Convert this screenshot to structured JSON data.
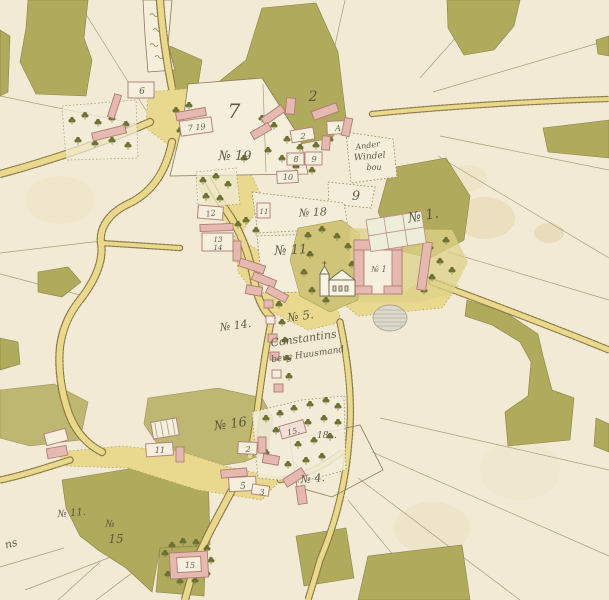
{
  "map": {
    "palette": {
      "parchment": "#f2ead4",
      "woodland_green": "#b0aa5c",
      "road_yellow": "#e9d98c",
      "road_edge_brown": "#8c7a48",
      "building_pink": "#e5b9b0",
      "building_outline": "#b5837d",
      "ink_text": "#55503e",
      "tree_green": "#6c7031",
      "pond_grey": "#dcd9ca"
    },
    "icons": {
      "tree": "broadleaf-tree-glyph",
      "church": "church-elevation-drawing",
      "pond": "hatched-oval-pond",
      "marsh": "squiggle-marsh-marks"
    },
    "labels": [
      {
        "name": "plot-7",
        "text": "7"
      },
      {
        "name": "plot-19",
        "text": "№ 19"
      },
      {
        "name": "plot-2",
        "text": "2"
      },
      {
        "name": "building-a",
        "text": "A"
      },
      {
        "name": "building-2-top",
        "text": "2"
      },
      {
        "name": "building-8",
        "text": "8"
      },
      {
        "name": "building-9",
        "text": "9"
      },
      {
        "name": "building-10",
        "text": "10"
      },
      {
        "name": "windel-line1",
        "text": "Ander"
      },
      {
        "name": "windel-line2",
        "text": "Windel"
      },
      {
        "name": "windel-line3",
        "text": "bou"
      },
      {
        "name": "plot-9",
        "text": "9"
      },
      {
        "name": "plot-18",
        "text": "№ 18"
      },
      {
        "name": "plot-1-script",
        "text": "№ 1."
      },
      {
        "name": "plot-11",
        "text": "№ 11."
      },
      {
        "name": "manor-plot-1",
        "text": "№ 1"
      },
      {
        "name": "building-12",
        "text": "12"
      },
      {
        "name": "building-11-small",
        "text": "11"
      },
      {
        "name": "building-13",
        "text": "13"
      },
      {
        "name": "building-14",
        "text": "14"
      },
      {
        "name": "plot-14",
        "text": "№ 14."
      },
      {
        "name": "plot-5",
        "text": "№ 5."
      },
      {
        "name": "constantins-line1",
        "text": "Constantins"
      },
      {
        "name": "constantins-line2",
        "text": "berg Huusmand"
      },
      {
        "name": "plot-16",
        "text": "№ 16"
      },
      {
        "name": "building-15-garden",
        "text": "15."
      },
      {
        "name": "plot-18-dots",
        "text": "18..."
      },
      {
        "name": "plot-4",
        "text": "№ 4."
      },
      {
        "name": "building-11-lower",
        "text": "11"
      },
      {
        "name": "building-2-lower",
        "text": "2"
      },
      {
        "name": "building-5-lower",
        "text": "5"
      },
      {
        "name": "building-3-lower",
        "text": "3"
      },
      {
        "name": "plot-11-bottomleft",
        "text": "№ 11."
      },
      {
        "name": "plot-15-no",
        "text": "№"
      },
      {
        "name": "plot-15-num",
        "text": "15"
      },
      {
        "name": "script-ns",
        "text": "ns"
      },
      {
        "name": "building-15-bottom",
        "text": "15"
      },
      {
        "name": "building-6",
        "text": "6"
      },
      {
        "name": "building-7-19",
        "text": "7 19"
      }
    ]
  }
}
